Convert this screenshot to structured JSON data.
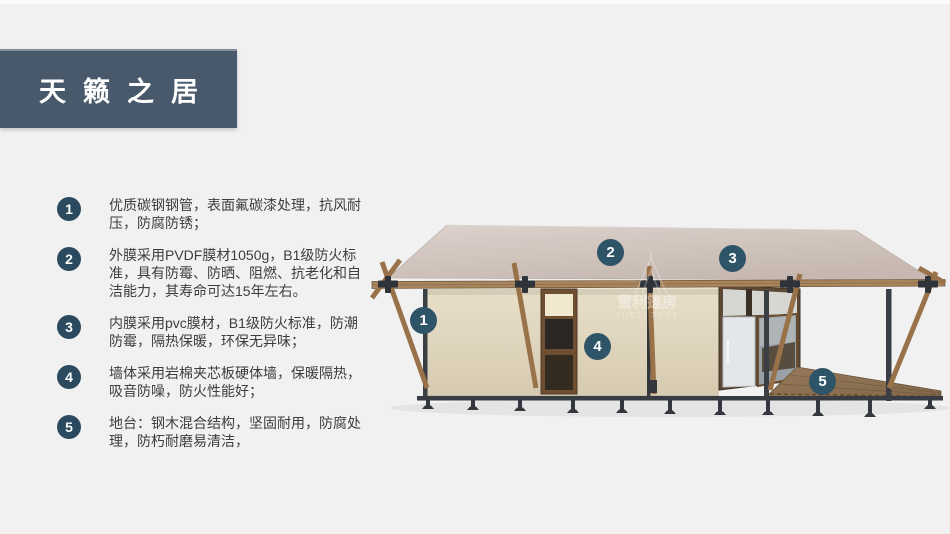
{
  "slide": {
    "title": "天籁之居",
    "features": [
      {
        "num": "1",
        "text": "优质碳钢钢管，表面氟碳漆处理，抗风耐压，防腐防锈；"
      },
      {
        "num": "2",
        "text": "外膜采用PVDF膜材1050g，B1级防火标准，具有防霉、防晒、阻燃、抗老化和自洁能力，其寿命可达15年左右。"
      },
      {
        "num": "3",
        "text": "内膜采用pvc膜材，B1级防火标准，防潮防霉，隔热保暖，环保无异味；"
      },
      {
        "num": "4",
        "text": "墙体采用岩棉夹芯板硬体墙，保暖隔热，吸音防噪，防火性能好；"
      },
      {
        "num": "5",
        "text": "地台：钢木混合结构，坚固耐用，防腐处理，防朽耐磨易清洁，"
      }
    ],
    "diagram": {
      "watermark_cn": "雪利篷房",
      "watermark_en": "XUELI TENT",
      "callouts": [
        {
          "num": "1",
          "target": "steel-and-wood-frame"
        },
        {
          "num": "2",
          "target": "outer-membrane-roof"
        },
        {
          "num": "3",
          "target": "inner-membrane"
        },
        {
          "num": "4",
          "target": "wall-panel"
        },
        {
          "num": "5",
          "target": "deck-platform"
        }
      ]
    },
    "colors": {
      "page_bg": "#f1f1f1",
      "banner_bg": "#48596b",
      "list_badge": "#2c4a5f",
      "callout_badge": "#2e5467",
      "body_text": "#3d3d3d",
      "roof": "#cfc2ba",
      "wall": "#e0d4bd",
      "wood": "#997249",
      "steel": "#373c42"
    }
  }
}
